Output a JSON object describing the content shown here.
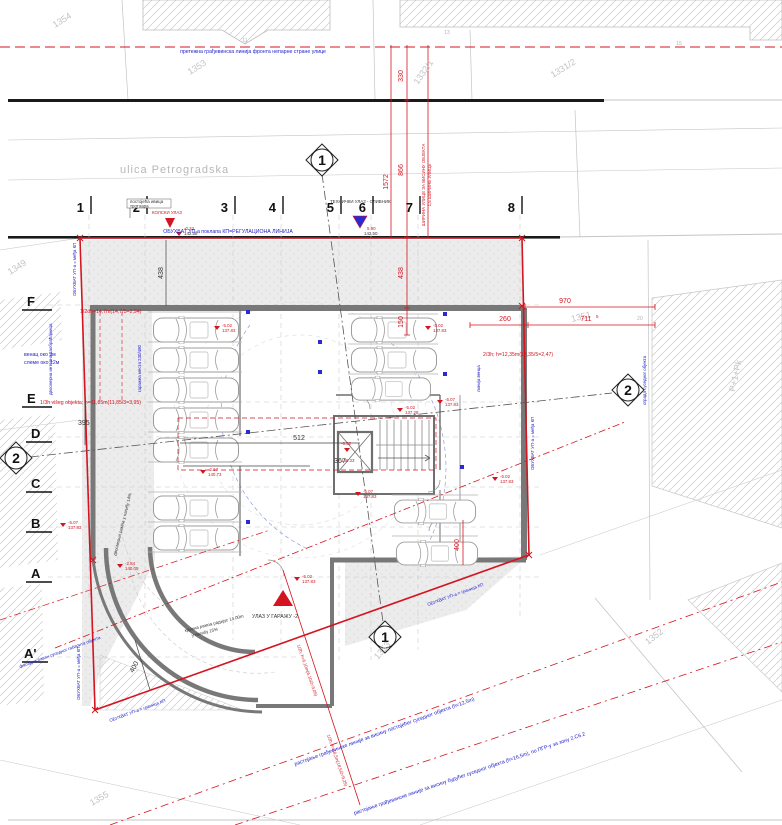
{
  "street": {
    "name": "ulica Petrogradska"
  },
  "parcels": {
    "p1354": "1354",
    "p1353_top": "1353",
    "p1332": "1332/1",
    "p1331": "1331/2",
    "p1349": "1349",
    "p1351": "1351",
    "p1352": "1352",
    "p1353_bottom": "1353",
    "p1355": "1355",
    "neighbor_floors": "P+1+Pk",
    "h11": "11",
    "h13": "13",
    "h15": "15",
    "h20": "20"
  },
  "grid": {
    "columns": [
      "1",
      "2",
      "3",
      "4",
      "5",
      "6",
      "7",
      "8"
    ],
    "rows": [
      "F",
      "E",
      "D",
      "C",
      "B",
      "A",
      "A'"
    ]
  },
  "sections": {
    "s1": "1",
    "s2": "2"
  },
  "dims": {
    "d330": "330",
    "d866": "866",
    "d1572": "1572",
    "d438_black": "438",
    "d438_red": "438",
    "d150": "150",
    "d970": "970",
    "d260": "260",
    "d711": "711",
    "d711_sup": "5",
    "d395": "395",
    "d512": "512",
    "d367": "367",
    "d400_red": "400",
    "d400_black": "400"
  },
  "elevations": [
    {
      "rel": "-0.32",
      "abs": "142.58"
    },
    {
      "rel": "5.90",
      "abs": "142.50"
    },
    {
      "rel": "-5.02",
      "abs": "137.83"
    },
    {
      "rel": "-5.02",
      "abs": "137.83"
    },
    {
      "rel": "-5.07",
      "abs": "137.83"
    },
    {
      "rel": "-5.02",
      "abs": "137.28"
    },
    {
      "rel": "-6.52",
      "abs": "136.33"
    },
    {
      "rel": "-5.07",
      "abs": "137.83"
    },
    {
      "rel": "-2.17",
      "abs": "140.73"
    },
    {
      "rel": "-2.84",
      "abs": "140.09"
    },
    {
      "rel": "-5.02",
      "abs": "137.83"
    },
    {
      "rel": "-5.07",
      "abs": "137.83"
    },
    {
      "rel": "-5.02",
      "abs": "137.83"
    }
  ],
  "red_notes": {
    "f_line": "1/2dh=14,7m(14,7/5=2,94)",
    "e_line": "1/3h višeg objekta; h=11,85m(11,85/3=3,95)",
    "right_line": "2/3h; h=12,35m(12,35/5=2,47)",
    "diag1": "1/2h; h=6,10m(6,10/2=3,05)",
    "diag2": "1/2h; h=18,5m(18,5/2=9,25)",
    "street_width1": "ШИРИНА УЛИЦЕ ЗА ВИСИНУ ОБЈЕКТА",
    "street_width2": "1,5 ШИРИНЕ УЛИЦЕ",
    "kolski": "КОЛСКИ УЛАЗ"
  },
  "blue_notes": {
    "top_building_line": "претежна грађевинска линија фронта непарне стране улице",
    "regulation_line": "ОБУХВАТ УП-а поклапа КП=РЕГУЛАЦИОНА ЛИНИЈА",
    "boundary_edge": "ОБУХВАТ УП-а = међа КП",
    "boundary_diag": "ОБУХВАТ УП-а = граница КП",
    "venac1": "венац око 9м",
    "venac2": "слеме око 12м",
    "road": "двосмерна интерна саобраћајница",
    "stalls": "гаражна места 230/480",
    "cornice": "линија венца",
    "fence": "ограда суседног објекта",
    "facade": "фасадна раван суседног габарита објекта",
    "long1": "растојање грађевинске линије за висину постојећег суседног објекта (h=12,5m)",
    "long2": "растојање грађевинске линије за висину будућег суседног објекта (h=16,5m), по ПГР-у за зону 2.С6.2"
  },
  "black_notes": {
    "sidewalk1": "постојећа ивица",
    "sidewalk2": "тротоара",
    "tehnicki": "ТЕХНИЧКИ УЛАЗ - СЛИВНИК",
    "entry": "УЛАЗ У ГАРАЖУ -2",
    "ramp_r1": "кружна рампа радијус 14,00m",
    "ramp_r2": "у нагибу 15%",
    "ramp_two": "двосмерна рампа у нагибу 14%"
  }
}
